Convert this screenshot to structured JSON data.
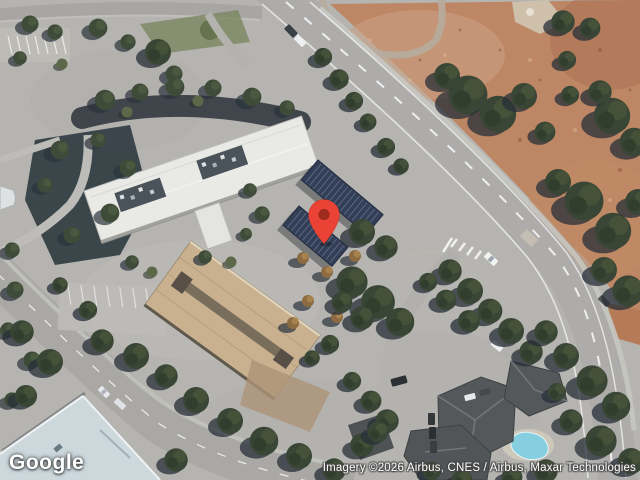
{
  "map": {
    "imagery_type": "satellite",
    "marker": {
      "icon": "map-pin-icon",
      "color": "#EA4335",
      "inner_color": "#9E2B1B"
    }
  },
  "branding": {
    "logo_text": "Google"
  },
  "attribution": {
    "text": "Imagery ©2026 Airbus, CNES / Airbus, Maxar Technologies"
  },
  "colors": {
    "pavement": "#b5b4b0",
    "asphalt_road": "#abaaa7",
    "dirt_field": "#bd8766",
    "tree_canopy": "#3a4635",
    "office_roof": "#e9e9e5",
    "garage_roof": "#c9b190",
    "solar_panels": "#333e57",
    "residential_roof": "#54585b",
    "pool_water": "#82d0e3",
    "lane_marking": "#ffffff"
  }
}
